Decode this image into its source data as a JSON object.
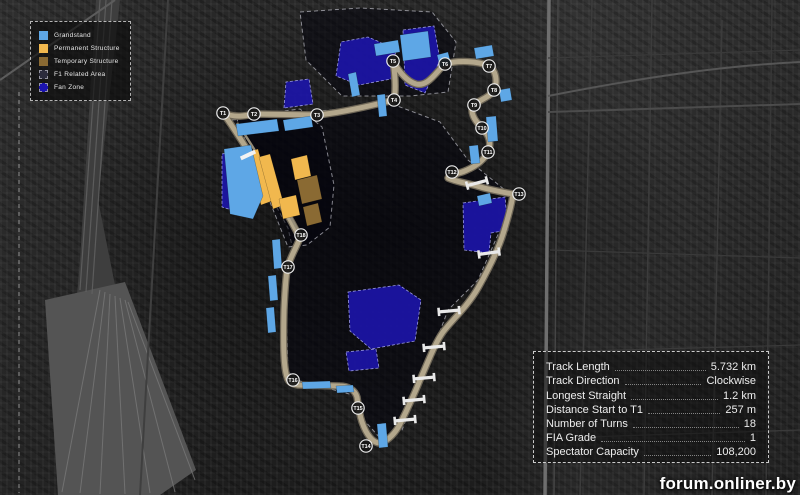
{
  "watermark": "forum.onliner.by",
  "legend": {
    "items": [
      {
        "label": "Grandstand",
        "color": "#5ea7e6",
        "dashed": false
      },
      {
        "label": "Permanent Structure",
        "color": "#f1b84e",
        "dashed": false
      },
      {
        "label": "Temporary Structure",
        "color": "#8a6a33",
        "dashed": false
      },
      {
        "label": "F1 Related Area",
        "color": "#2b2b3c",
        "dashed": true
      },
      {
        "label": "Fan Zone",
        "color": "#1c14ae",
        "dashed": true
      }
    ]
  },
  "stats": {
    "rows": [
      {
        "label": "Track Length",
        "value": "5.732 km"
      },
      {
        "label": "Track Direction",
        "value": "Clockwise"
      },
      {
        "label": "Longest Straight",
        "value": "1.2 km"
      },
      {
        "label": "Distance Start to T1",
        "value": "257 m"
      },
      {
        "label": "Number of Turns",
        "value": "18"
      },
      {
        "label": "FIA Grade",
        "value": "1"
      },
      {
        "label": "Spectator Capacity",
        "value": "108,200"
      }
    ]
  },
  "map": {
    "colors": {
      "track": "#b3a78c",
      "track_edge": "#6f6757",
      "pit_lane": "#968d79",
      "grandstand": "#5ea7e6",
      "permanent": "#f1b84e",
      "temporary": "#8a6a33",
      "fanzone": "#1c14ae",
      "fanzone_border": "#9a9ae0",
      "f1area_fill": "rgba(3,3,12,0.55)",
      "f1area_border": "rgba(215,215,225,0.6)",
      "bridge": "#e9e9e9",
      "marker_fill": "rgba(22,22,22,0.92)",
      "marker_ring": "#ececec"
    },
    "track_path": "M 223,113 C 235,118 245,116 254,114 L 317,115 C 340,113 370,106 394,100 C 396,90 395,74 393,61 C 398,70 406,81 416,84 C 428,87 436,72 445,64 C 458,60 478,61 489,66 C 496,70 498,82 494,90 C 490,97 481,99 474,105 C 469,111 474,120 482,128 C 489,135 492,143 488,152 C 484,160 476,166 467,170 C 459,174 450,174 448,178 C 456,182 467,183 477,186 C 490,190 502,192 513,194 C 512,203 508,218 503,234 C 497,253 487,272 478,288 C 467,307 452,320 443,332 C 435,343 428,362 420,380 C 414,395 407,410 400,424 C 396,432 389,440 381,443 C 373,444 366,434 362,422 C 359,413 358,404 357,397 C 355,390 348,386 340,386 L 298,385 C 292,384 288,382 287,377 C 284,368 283,350 284,310 C 285,288 286,272 288,266 C 290,258 296,248 300,238 C 292,222 278,198 264,176 C 252,157 236,131 223,113 Z",
    "pit_lane_path": "M 300,234 C 290,216 278,194 266,170 C 257,153 246,136 237,123",
    "turns": [
      {
        "label": "T1",
        "x": 223,
        "y": 113
      },
      {
        "label": "T2",
        "x": 254,
        "y": 114
      },
      {
        "label": "T3",
        "x": 317,
        "y": 115
      },
      {
        "label": "T4",
        "x": 394,
        "y": 100
      },
      {
        "label": "T5",
        "x": 393,
        "y": 61
      },
      {
        "label": "T6",
        "x": 445,
        "y": 64
      },
      {
        "label": "T7",
        "x": 489,
        "y": 66
      },
      {
        "label": "T8",
        "x": 494,
        "y": 90
      },
      {
        "label": "T9",
        "x": 474,
        "y": 105
      },
      {
        "label": "T10",
        "x": 482,
        "y": 128
      },
      {
        "label": "T11",
        "x": 488,
        "y": 152
      },
      {
        "label": "T12",
        "x": 452,
        "y": 172
      },
      {
        "label": "T13",
        "x": 519,
        "y": 194
      },
      {
        "label": "T14",
        "x": 366,
        "y": 446
      },
      {
        "label": "T15",
        "x": 358,
        "y": 408
      },
      {
        "label": "T16",
        "x": 293,
        "y": 380
      },
      {
        "label": "T17",
        "x": 288,
        "y": 267
      },
      {
        "label": "T18",
        "x": 301,
        "y": 235
      }
    ],
    "f1_areas": [
      {
        "points": "232,120 310,112 392,104 440,122 468,160 500,186 512,196 500,230 478,280 448,310 432,352 402,430 380,438 364,420 357,396 300,381 288,372 286,300 293,250 288,228 262,180 241,144"
      },
      {
        "points": "236,117 300,109 322,127 334,185 330,227 307,245 288,247"
      },
      {
        "points": "300,12 360,8 432,12 456,42 448,92 410,96 342,96 306,60"
      }
    ],
    "zones": [
      {
        "type": "fanzone",
        "points": "336,76 341,42 368,37 396,49 391,79 359,85"
      },
      {
        "type": "fanzone",
        "points": "403,30 434,26 440,60 425,93 405,85"
      },
      {
        "type": "fanzone",
        "points": "284,108 286,82 309,79 313,104"
      },
      {
        "type": "fanzone",
        "points": "222,154 243,150 247,186 238,212 222,207"
      },
      {
        "type": "fanzone",
        "points": "463,203 505,197 508,230 491,233 489,253 464,250"
      },
      {
        "type": "fanzone",
        "points": "348,292 399,285 421,300 415,341 371,349 350,331"
      },
      {
        "type": "fanzone",
        "points": "346,352 376,349 379,368 349,371"
      },
      {
        "type": "permanent",
        "points": "247,152 258,149 272,201 261,205"
      },
      {
        "type": "permanent",
        "points": "259,157 270,154 284,205 273,209"
      },
      {
        "type": "permanent",
        "points": "291,159 307,155 311,176 295,180"
      },
      {
        "type": "permanent",
        "points": "279,199 296,195 300,215 283,219"
      },
      {
        "type": "temporary",
        "points": "297,180 317,175 322,199 302,204"
      },
      {
        "type": "temporary",
        "points": "303,207 318,203 322,222 307,226"
      },
      {
        "type": "grandstand",
        "points": "236,124 277,119 279,131 238,136"
      },
      {
        "type": "grandstand",
        "points": "283,120 311,116 313,127 285,131"
      },
      {
        "type": "grandstand",
        "points": "224,149 251,145 263,196 253,219 230,214"
      },
      {
        "type": "grandstand",
        "points": "348,74 356,72 360,95 352,97"
      },
      {
        "type": "grandstand",
        "points": "400,35 428,31 431,57 403,61"
      },
      {
        "type": "grandstand",
        "points": "374,44 398,40 400,52 376,56"
      },
      {
        "type": "grandstand",
        "points": "377,95 385,94 387,116 379,117"
      },
      {
        "type": "grandstand",
        "points": "486,117 496,116 498,141 488,142"
      },
      {
        "type": "grandstand",
        "points": "469,146 478,145 480,163 471,164"
      },
      {
        "type": "grandstand",
        "points": "477,196 490,193 492,203 479,206"
      },
      {
        "type": "grandstand",
        "points": "302,382 330,381 331,388 303,389"
      },
      {
        "type": "grandstand",
        "points": "336,386 353,385 354,392 337,393"
      },
      {
        "type": "grandstand",
        "points": "272,240 280,239 282,268 274,269"
      },
      {
        "type": "grandstand",
        "points": "268,276 276,275 278,300 270,301"
      },
      {
        "type": "grandstand",
        "points": "266,308 274,307 276,332 268,333"
      },
      {
        "type": "grandstand",
        "points": "377,424 386,423 388,447 379,448"
      },
      {
        "type": "grandstand",
        "points": "437,55 448,52 451,64 440,67"
      },
      {
        "type": "grandstand",
        "points": "474,48 492,45 494,56 476,59"
      },
      {
        "type": "grandstand",
        "points": "499,90 510,88 512,100 501,102"
      }
    ],
    "bridges": [
      {
        "x": 477,
        "y": 183,
        "angle": -15
      },
      {
        "x": 489,
        "y": 253,
        "angle": -8
      },
      {
        "x": 449,
        "y": 311,
        "angle": -5
      },
      {
        "x": 434,
        "y": 347,
        "angle": -5
      },
      {
        "x": 424,
        "y": 378,
        "angle": -5
      },
      {
        "x": 414,
        "y": 400,
        "angle": -5
      },
      {
        "x": 405,
        "y": 420,
        "angle": -5
      }
    ],
    "start_line": {
      "x": 248,
      "y": 155,
      "angle": -25
    }
  }
}
